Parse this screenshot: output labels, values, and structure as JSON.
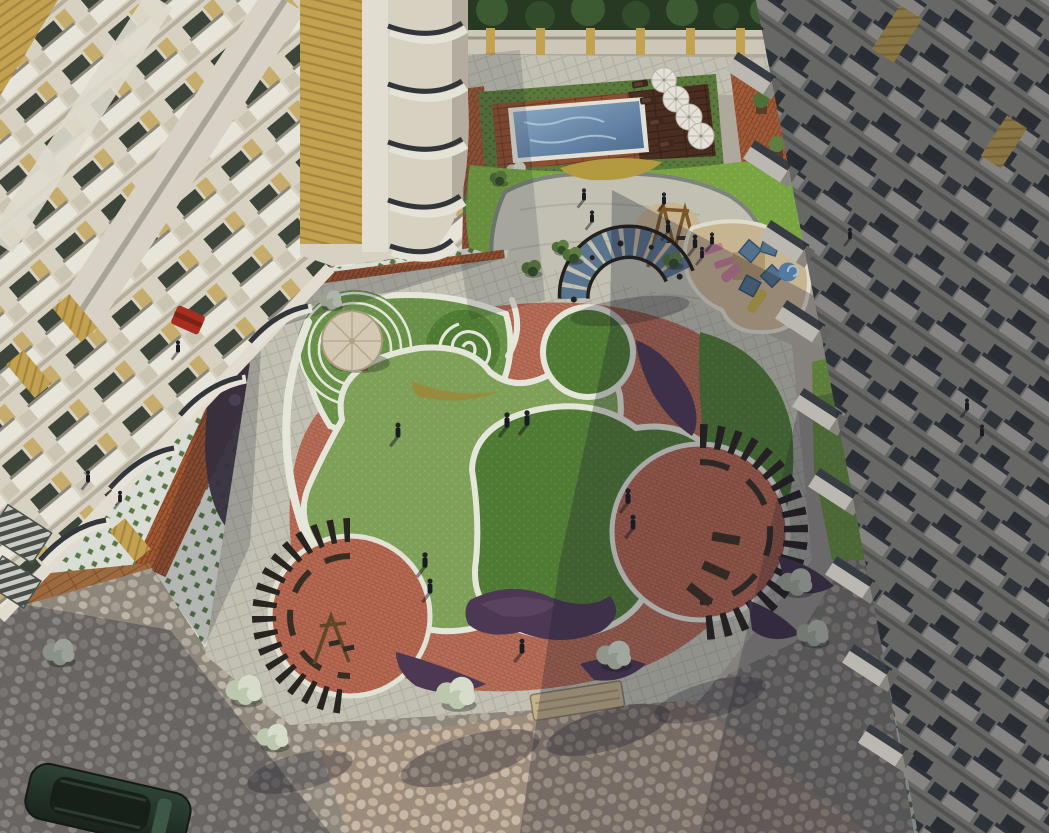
{
  "scene": {
    "title": "Aerial 3D rendering of a residential apartment complex courtyard",
    "description": "Top-down architectural visualization showing a landscaped central courtyard between three apartment towers: a rooftop swimming pool with sun umbrellas and loungers, curved lawns in two greens with white ribbon walkways, a spiral lawn motif, an umbrella gazebo with concentric rings, two arc-shaped timber pergolas over red-brick patios, a children's play area with slides and shade canopies, purple flower beds, white flowering shrubs, patterned paving plazas, and a parked car at the bottom left.",
    "lighting": "late-day sun from the upper right casting long shadows toward the lower left",
    "areas": {
      "pool": "swimming pool with hedge border, timber deck, 4 white umbrellas and dark loungers",
      "gazebo": "cream umbrella gazebo ringed by concentric white circles on lawn",
      "spiral": "white spiral path inlaid in a circular lawn",
      "playground": "kids play structure with blue shade canopies, pink benches, spiral and straight slides, timber swing frame",
      "pergolas": "two dark slatted arc pergolas over circular red-brick patios and one fan pergola with blue glass",
      "paving": "green-diamond checker tiles, grey octagon cobbles, tan cobbles, orange brick borders and herringbone strips",
      "buildings": "cream residential towers with white box balconies, dark railings and yellow accent bands"
    }
  },
  "counts": {
    "residential_towers": 3,
    "pool_umbrellas": 4,
    "pergolas": 3,
    "people_visible": 17,
    "parked_cars": 1,
    "white_shrubs": 8
  },
  "colors": {
    "wall_cream": "#ded7c5",
    "wall_cream2": "#d0c9b6",
    "balc_white": "#efebdf",
    "win_dark": "#3a4237",
    "wallR": "#908e85",
    "balcR_box": "#bfbdb3",
    "railR": "#34393f",
    "winR": "#2c3034",
    "accent_yellow": "#c7a44e",
    "accent_yellow2": "#a8863a",
    "plaza_tile": "#e1e4da",
    "plaza_green": "#55793f",
    "cobble_grout": "#8e877b",
    "cobble_stone": "#b6aea0",
    "cobble_stone2": "#a9a092",
    "cobble_stone3": "#c0b8a9",
    "tan_grout": "#a08f7b",
    "tan_stone": "#c9b59c",
    "tan_stone2": "#d2c0a9",
    "brick": "#a3552d",
    "brick_line": "#7e3e1e",
    "patio_red": "#bc6a50",
    "patio_line": "#a35440",
    "deck_wood": "#8e4d2c",
    "deck_line": "#70371d",
    "deck_dark": "#46291a",
    "deck_dark_line": "#301b0e",
    "woodL": "#a06a3c",
    "woodL_line": "#7c4e28",
    "lawn_light": "#7fa356",
    "lawn_light2": "#8fb264",
    "lawn_mid": "#699245",
    "lawn_mid2": "#7aa352",
    "lawn_dark": "#4e7c2f",
    "lawn_dark2": "#5d8c3a",
    "lawn_bright": "#79a83e",
    "lawn_bright2": "#8ab84c",
    "hedge": "#5a7a38",
    "hedge2": "#48642b",
    "pave": "#c6c5b5",
    "pave_line": "#b2b1a1",
    "path_white": "#ecede0",
    "water_light": "#8fb0cd",
    "water_dark": "#47688e",
    "umbrella": "#eae8de",
    "pergola": "#241f19",
    "glass": "#52708c",
    "purple": "#4a3550",
    "purple2": "#5d4363",
    "sand": "#cdb992",
    "shrub_white": "#dde3cf",
    "shrub_white2": "#c2ccb1",
    "tree_green": "#4e6f33",
    "tree_dark": "#2f4a24",
    "car": "#2a4030",
    "car_dark": "#141f16",
    "shadow": "rgba(18,22,38,0.28)"
  }
}
